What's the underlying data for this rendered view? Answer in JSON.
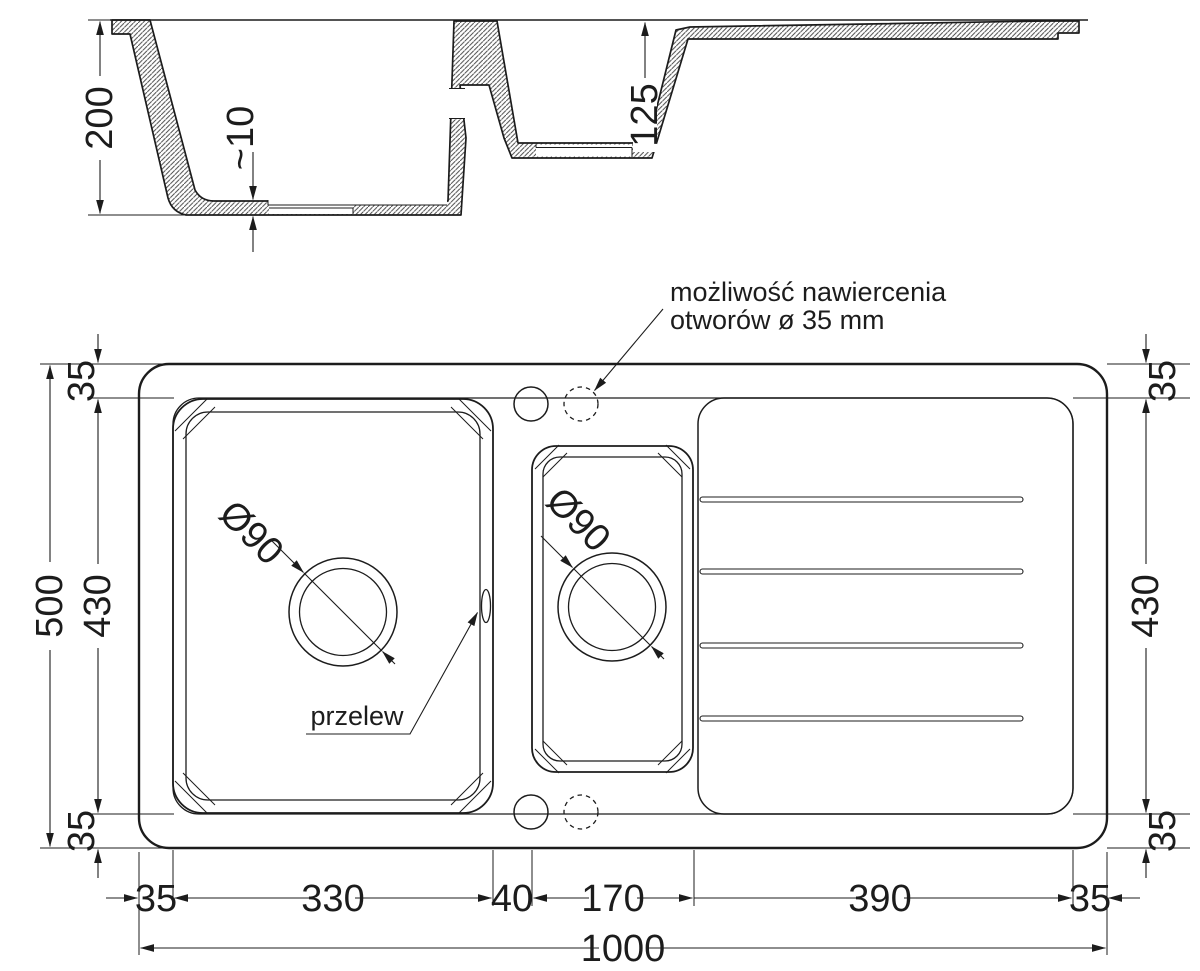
{
  "drawing": {
    "section": {
      "depth_total": "200",
      "floor_thickness": "~10",
      "depth_small_bowl": "125"
    },
    "plan": {
      "left": {
        "overall": "500",
        "inner": "430",
        "top_margin": "35",
        "bottom_margin": "35"
      },
      "right": {
        "inner": "430",
        "top_margin": "35",
        "bottom_margin": "35"
      },
      "bottom": {
        "left_margin": "35",
        "main_bowl": "330",
        "divider": "40",
        "small_bowl": "170",
        "drainer": "390",
        "right_margin": "35",
        "overall": "1000"
      },
      "main_drain_label": "Ø90",
      "small_drain_label": "Ø90",
      "overflow_label": "przelew",
      "drill_note_line1": "możliwość nawiercenia",
      "drill_note_line2": "otworów ø 35 mm"
    },
    "colors": {
      "line": "#1c1c1c",
      "hatch": "#4a4a4a",
      "background": "#ffffff"
    }
  }
}
